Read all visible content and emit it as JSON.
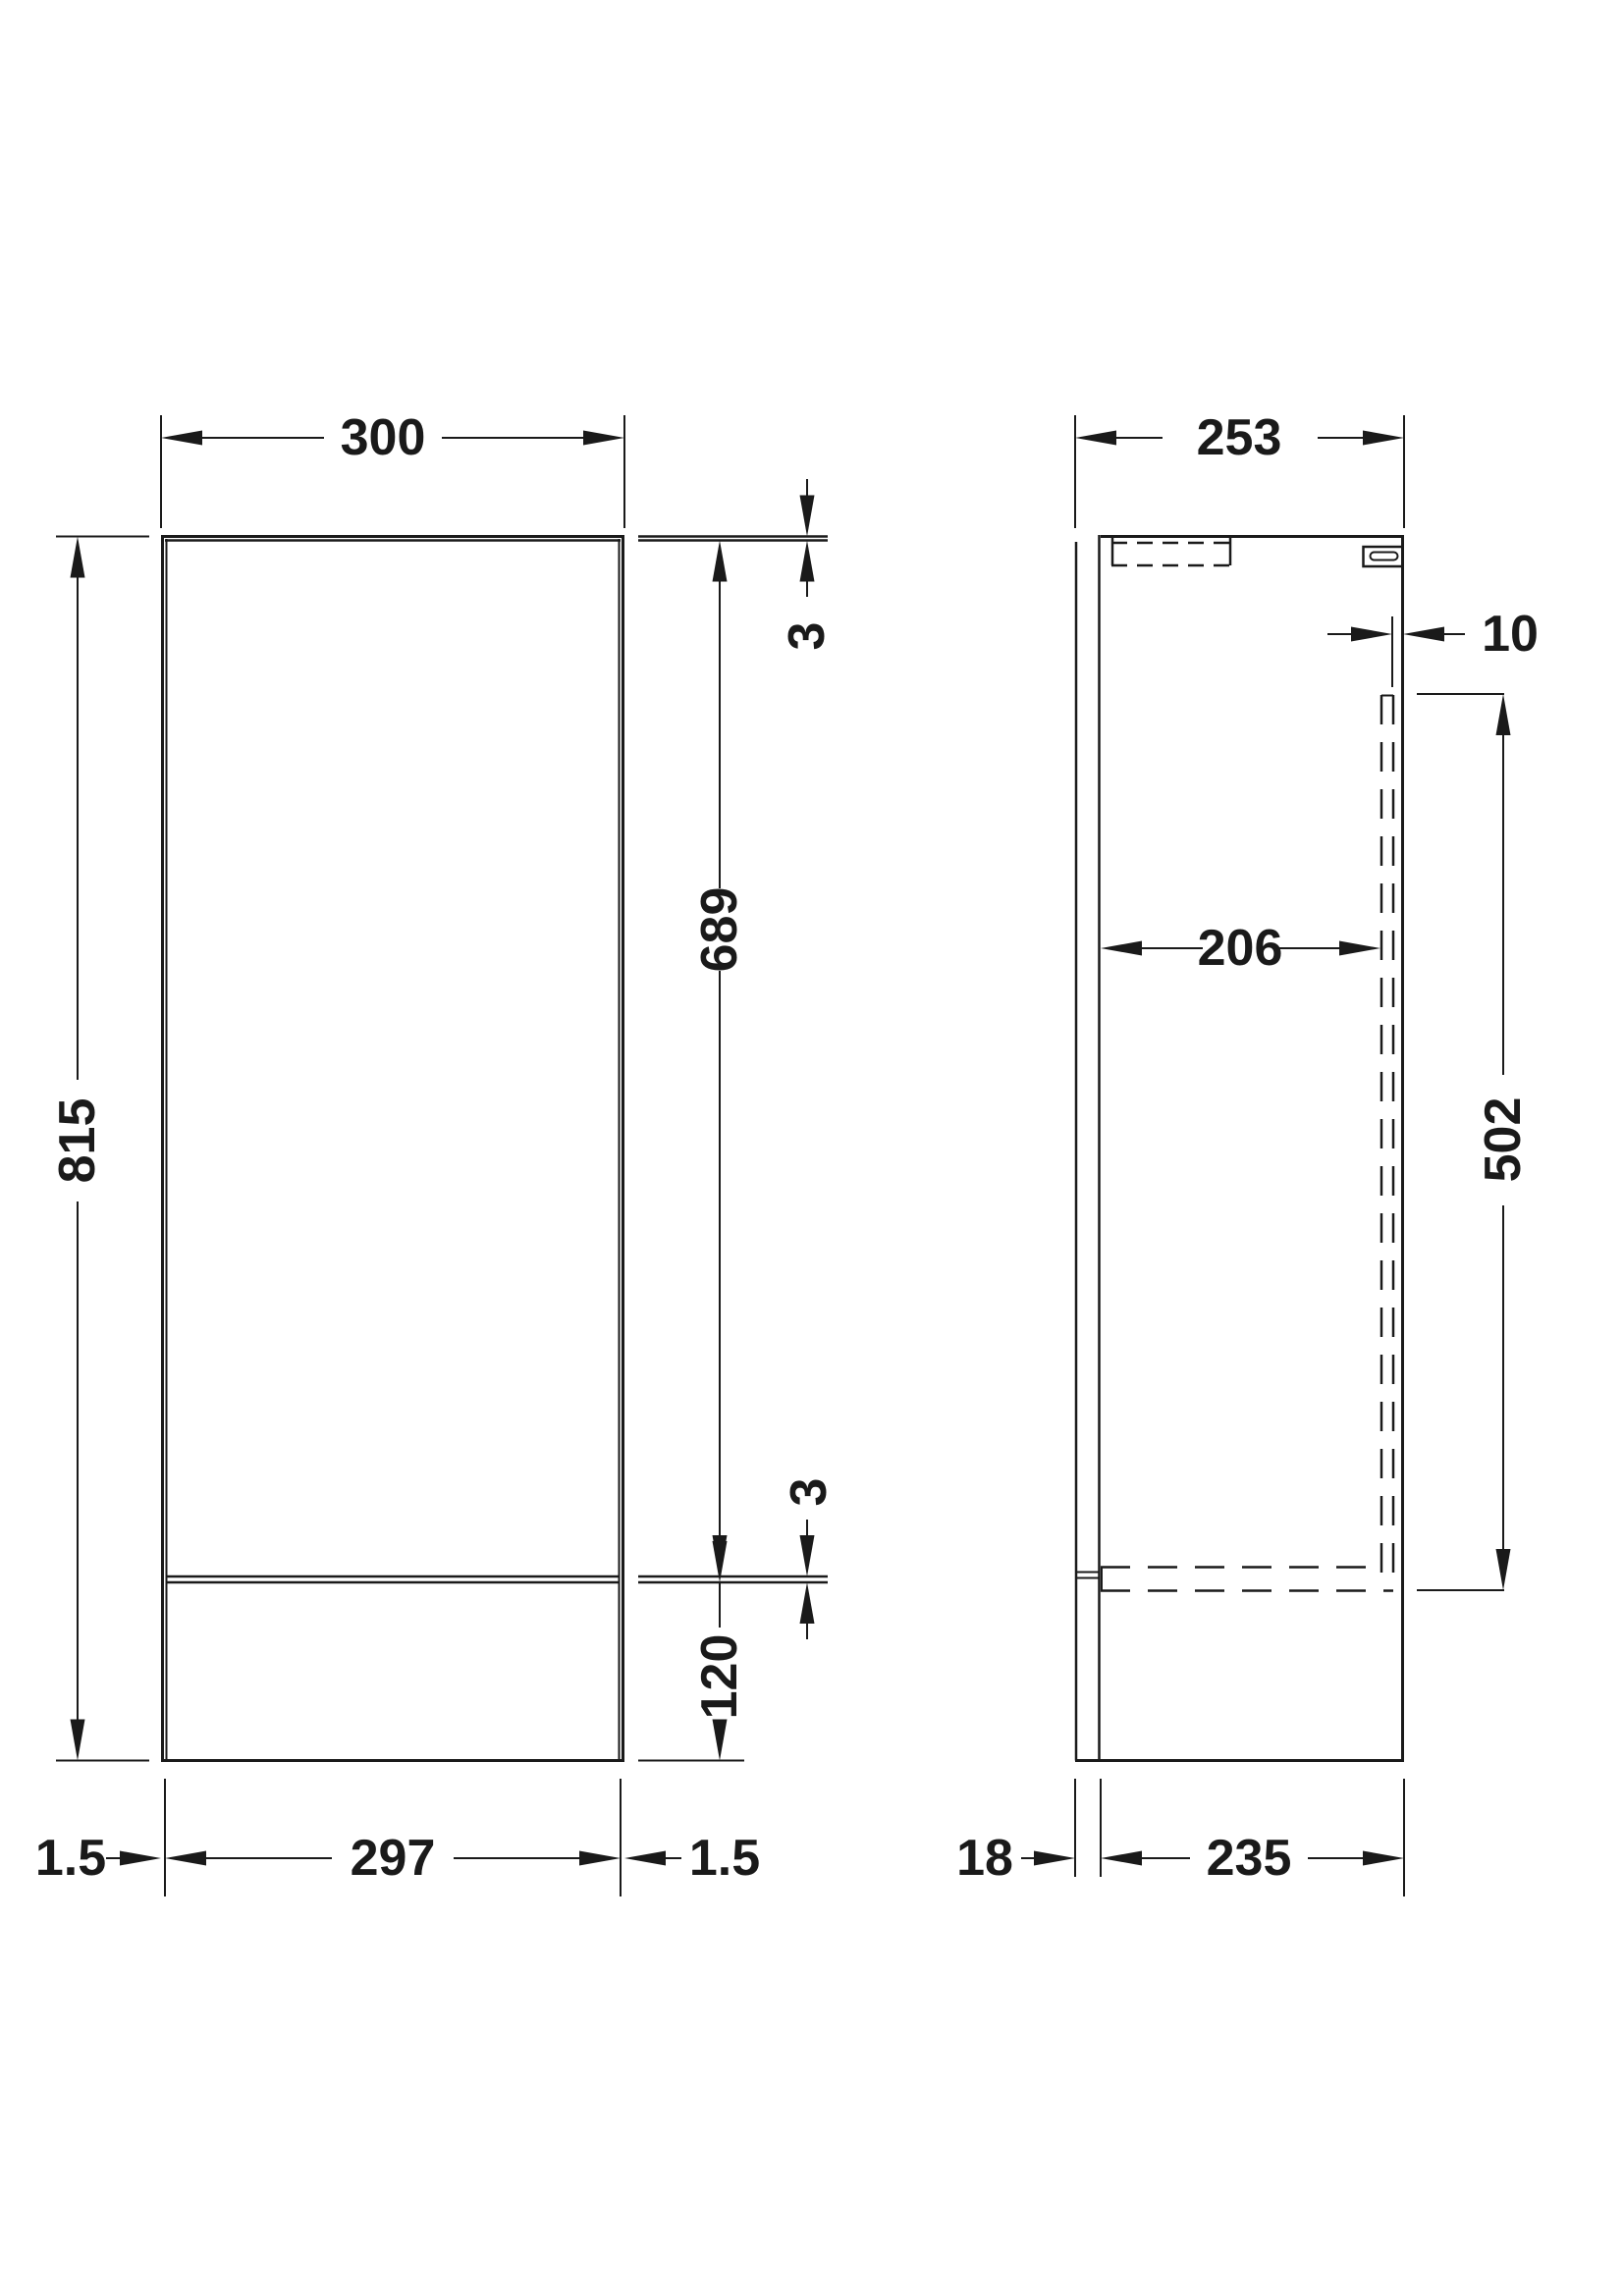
{
  "drawing": {
    "front_view": {
      "overall_width": "300",
      "overall_height": "815",
      "top_panel_thickness": "3",
      "door_height": "689",
      "door_bottom_gap": "3",
      "plinth_height": "120",
      "plinth_width": "297",
      "side_inset_left": "1.5",
      "side_inset_right": "1.5"
    },
    "side_view": {
      "overall_depth": "253",
      "back_panel_offset": "10",
      "internal_depth": "206",
      "back_recess_height": "502",
      "door_thickness": "18",
      "carcass_depth": "235"
    },
    "colors": {
      "line": "#1a1a1a",
      "background": "#ffffff"
    }
  }
}
